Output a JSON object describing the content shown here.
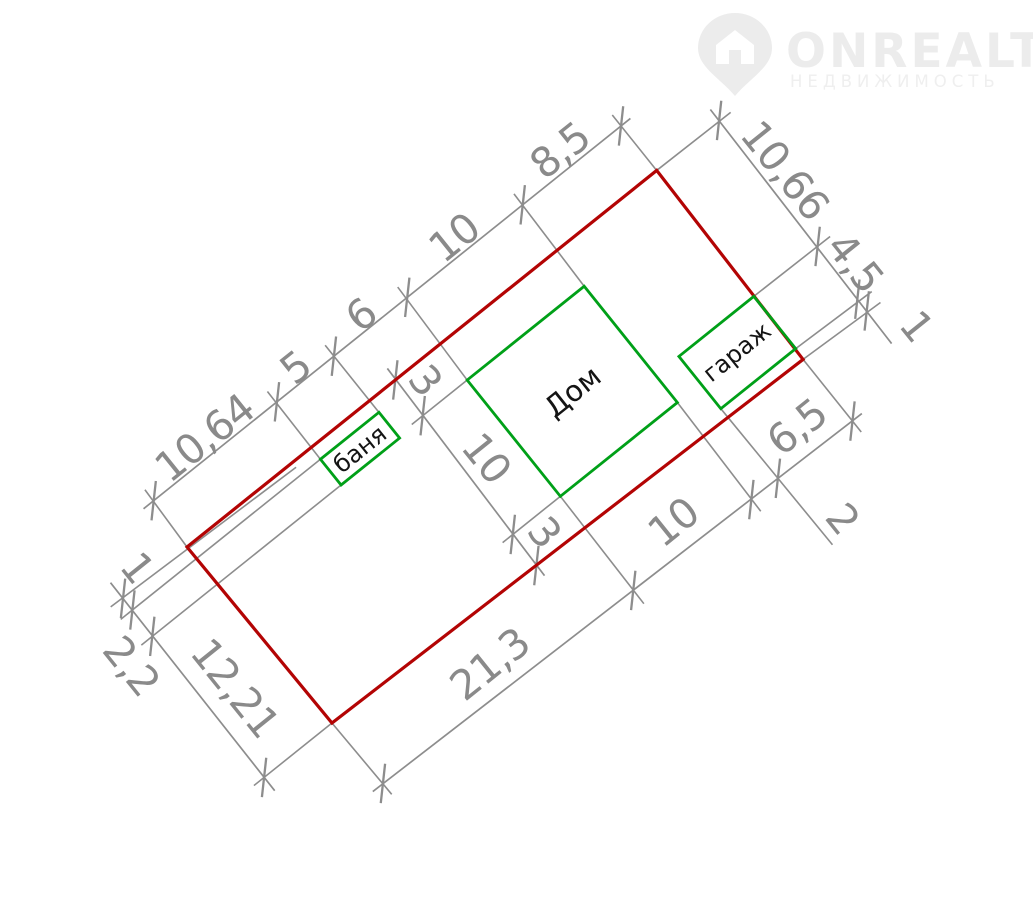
{
  "watermark": {
    "brand": "ONREALT",
    "tagline": "НЕДВИЖИМОСТЬ"
  },
  "buildings": {
    "house": "Дом",
    "bathhouse": "баня",
    "garage": "гараж"
  },
  "dimensions": {
    "top_left_chain": [
      "10,64",
      "5",
      "6",
      "10",
      "8,5"
    ],
    "top_right_chain": [
      "10,66",
      "4,5",
      "1"
    ],
    "bottom_right_chain": [
      "21,3",
      "10",
      "2",
      "6,5"
    ],
    "bottom_left_chain": [
      "1",
      "2,2",
      "12,21"
    ],
    "house_cross_chain": [
      "3",
      "10",
      "3"
    ]
  },
  "colors": {
    "plot_boundary": "#b30404",
    "building_outline": "#00a018",
    "dimension_gray": "#8a8a8a"
  }
}
